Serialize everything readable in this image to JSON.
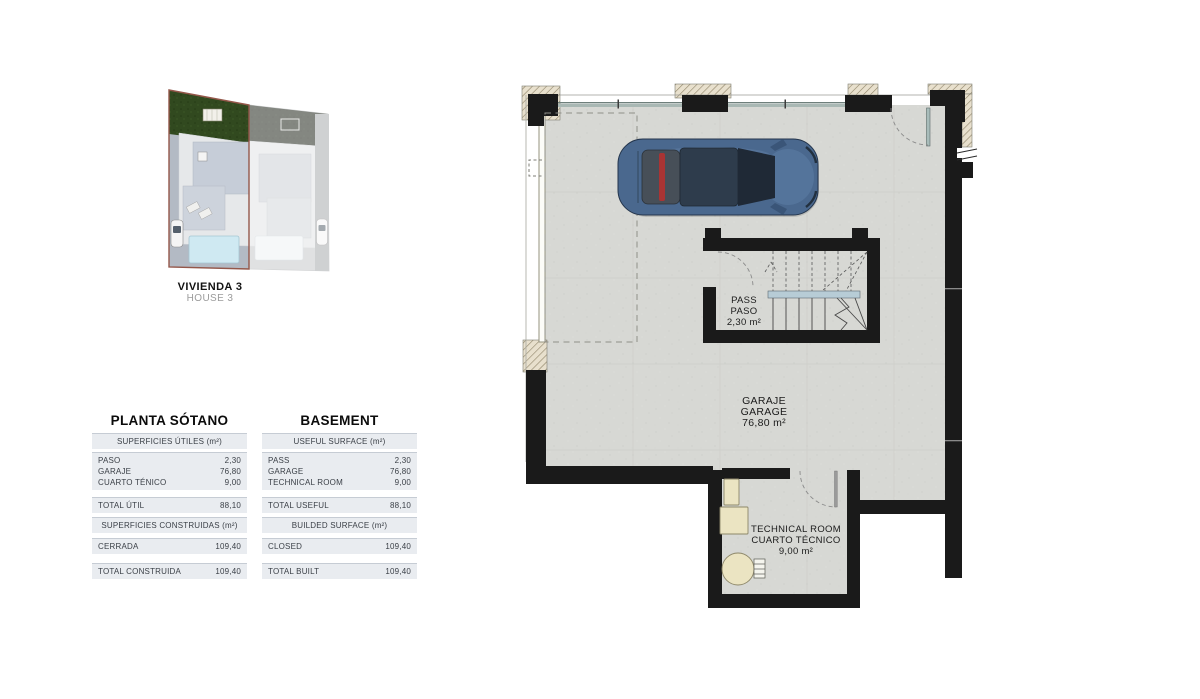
{
  "site_thumbnail": {
    "name_primary": "VIVIENDA 3",
    "name_secondary": "HOUSE 3"
  },
  "tables": {
    "spanish": {
      "title": "PLANTA SÓTANO",
      "useful_header": "SUPERFICIES ÚTILES (m²)",
      "rows": [
        {
          "label": "PASO",
          "value": "2,30"
        },
        {
          "label": "GARAJE",
          "value": "76,80"
        },
        {
          "label": "CUARTO TÉNICO",
          "value": "9,00"
        }
      ],
      "total": {
        "label": "TOTAL ÚTIL",
        "value": "88,10"
      },
      "built_header": "SUPERFICIES CONSTRUIDAS (m²)",
      "closed": {
        "label": "CERRADA",
        "value": "109,40"
      },
      "total_built": {
        "label": "TOTAL CONSTRUIDA",
        "value": "109,40"
      }
    },
    "english": {
      "title": "BASEMENT",
      "useful_header": "USEFUL SURFACE (m²)",
      "rows": [
        {
          "label": "PASS",
          "value": "2,30"
        },
        {
          "label": "GARAGE",
          "value": "76,80"
        },
        {
          "label": "TECHNICAL ROOM",
          "value": "9,00"
        }
      ],
      "total": {
        "label": "TOTAL USEFUL",
        "value": "88,10"
      },
      "built_header": "BUILDED SURFACE (m²)",
      "closed": {
        "label": "CLOSED",
        "value": "109,40"
      },
      "total_built": {
        "label": "TOTAL BUILT",
        "value": "109,40"
      }
    }
  },
  "floor_plan": {
    "rooms": {
      "pass": {
        "line1": "PASS",
        "line2": "PASO",
        "area": "2,30 m²"
      },
      "garage": {
        "line1": "GARAJE",
        "line2": "GARAGE",
        "area": "76,80 m²"
      },
      "technical": {
        "line1": "TECHNICAL ROOM",
        "line2": "CUARTO TÉCNICO",
        "area": "9,00 m²"
      }
    },
    "colors": {
      "wall": "#1a1a1a",
      "floor": "#d7d8d4",
      "car_body": "#4a688e",
      "stair_landing": "#b7ccd6",
      "equipment": "#ebe4c2",
      "highlight_outline": "#94574a"
    }
  }
}
